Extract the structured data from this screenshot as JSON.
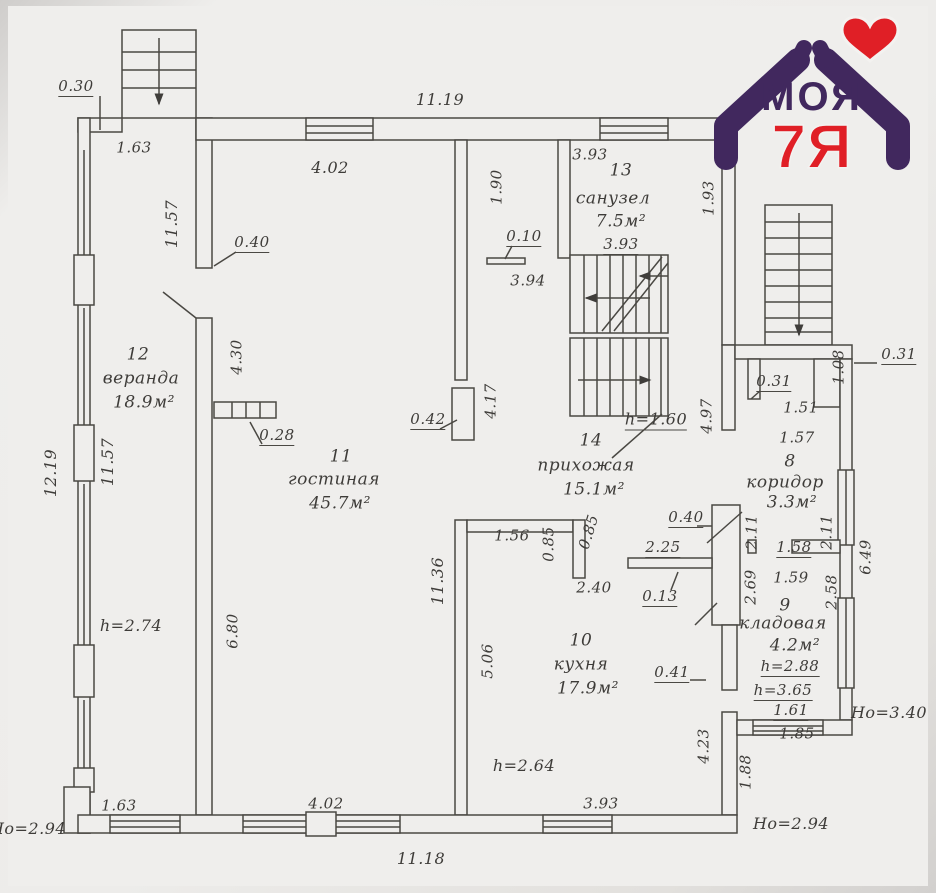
{
  "logo": {
    "word": "МОЯ",
    "brand": "7Я"
  },
  "colors": {
    "logo_purple": "#41285e",
    "logo_red": "#e01f26",
    "ink": "#3e3c39",
    "line": "#4a4843"
  },
  "rooms": {
    "veranda": {
      "num": "12",
      "name": "веранда",
      "area": "18.9м²"
    },
    "living": {
      "num": "11",
      "name": "гостиная",
      "area": "45.7м²"
    },
    "kitchen": {
      "num": "10",
      "name": "кухня",
      "area": "17.9м²"
    },
    "hall": {
      "num": "14",
      "name": "прихожая",
      "area": "15.1м²"
    },
    "bath": {
      "num": "13",
      "name": "санузел",
      "area": "7.5м²"
    },
    "corridor": {
      "num": "8",
      "name": "коридор",
      "area": "3.3м²"
    },
    "storage": {
      "num": "9",
      "name": "кладовая",
      "area": "4.2м²"
    }
  },
  "dims": {
    "d030": "0.30",
    "d163t": "1.63",
    "d1119": "11.19",
    "d402t": "4.02",
    "d190": "1.90",
    "d393t": "3.93",
    "d393i": "3.93",
    "d010": "0.10",
    "d394": "3.94",
    "d040l": "0.40",
    "d1157t": "11.57",
    "d1219": "12.19",
    "d1157m": "11.57",
    "d430": "4.30",
    "d028": "0.28",
    "d042": "0.42",
    "d417": "4.17",
    "d193": "1.93",
    "d497": "4.97",
    "h160": "h=1.60",
    "d031a": "0.31",
    "d151": "1.51",
    "d108": "1.08",
    "d031b": "0.31",
    "d157": "1.57",
    "d040r": "0.40",
    "d211a": "2.11",
    "d211b": "2.11",
    "d158": "1.58",
    "d649": "6.49",
    "d225": "2.25",
    "d013": "0.13",
    "d269": "2.69",
    "d159": "1.59",
    "d258": "2.58",
    "h288": "h=2.88",
    "h365": "h=3.65",
    "d161": "1.61",
    "ho340": "Но=3.40",
    "d185": "1.85",
    "d188": "1.88",
    "ho294r": "Но=2.94",
    "d423": "4.23",
    "d041": "0.41",
    "h264": "h=2.64",
    "d240": "2.40",
    "d156": "1.56",
    "d085a": "0.85",
    "d085b": "0.85",
    "d506": "5.06",
    "d1136": "11.36",
    "d680": "6.80",
    "h274": "h=2.74",
    "ho294l": "Но=2.94",
    "d163b": "1.63",
    "d402b": "4.02",
    "d1118": "11.18",
    "d393k": "3.93"
  }
}
